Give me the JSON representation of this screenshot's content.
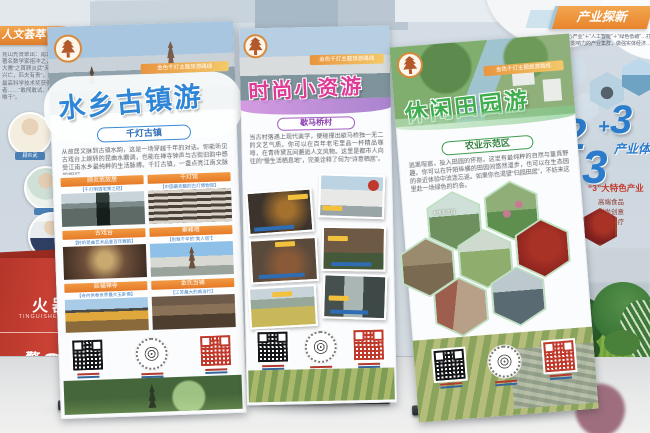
{
  "background": {
    "left_wall": {
      "ribbon_label": "人文荟萃",
      "info_text": "昆山先贤辈出：南北朝著名数学家祖冲之，“三大儒”之首顾炎武“天下兴亡，匹夫有责”，国家最高科学技术奖获得者……“敢闯敢试、唯实唯干”。",
      "figure_label": "顾炎武"
    },
    "fire_box": {
      "line1": "火器箱",
      "line2": "TINGUISHER·BOX",
      "line3": "警 ☎ 119",
      "line4": "ELEPHONE 119"
    },
    "right_wall": {
      "header": "产业探新",
      "intro": "以“核心产业”＋“人工智能”＋“绿色低碳”…打造具有影响力的产业集群，做强实体经济…",
      "num_left": "2",
      "plus": "+",
      "num_right": "3",
      "num_big": "3",
      "system_label": "产业体系",
      "feature_title": "“3”大特色产业",
      "feature_items": [
        "高端食品",
        "时尚创意",
        "休闲医疗"
      ]
    }
  },
  "banners": {
    "route_ribbon": "金色千灯主题旅游路线",
    "left": {
      "title": "水乡古镇游",
      "subtitle": "千灯古镇",
      "intro": "从故居文脉到古镇水韵，这是一场穿越千年的对话。你能听见古戏台上婉转的昆曲水磨调，也能在禅寺钟声与古街旧韵中感受江南水乡最纯粹的生活脉搏。千灯古镇，一盏点亮江南文脉的明灯。",
      "cards": [
        {
          "title": "顾炎武故居",
          "caption": "【千灯明清宅第之冠】"
        },
        {
          "title": "千灯馆",
          "caption": "【中国最完整的古灯博物馆】"
        },
        {
          "title": "古戏台",
          "caption": "【聆听昆曲艺术品鉴百年雅韵】"
        },
        {
          "title": "秦峰塔",
          "caption": "【别致千年的“美人塔”】"
        },
        {
          "title": "延福禅寺",
          "caption": "【寺内供奉世界最大玉卧佛】"
        },
        {
          "title": "金氏当铺",
          "caption": "【江苏最大的典当行】"
        }
      ]
    },
    "middle": {
      "title": "时尚小资游",
      "subtitle": "歇马桥村",
      "intro": "当古村落遇上现代美学，便碰撞出歇马桥独一无二的文艺气质。你可以在百年老宅里品一杯精品咖啡，在青砖黛瓦间邂逅人文风物。这里是都市人向往的“慢生活栖息地”，完美诠释了何为“诗意栖居”。"
    },
    "right": {
      "title": "休闲田园游",
      "subtitle": "农业示范区",
      "intro": "逃离喧嚣，投入田园的怀抱，这里有最纯粹的自然与童真野趣。你可以在阡陌纵横的田园间悠然漫步，也可以在生态园的亲近体验中流连忘返。如果你也渴望“归园田居”，不妨来这里赴一场绿色的约会。",
      "hex_label": "大唐生态园"
    }
  },
  "icons": {
    "logo": "qiandeng-pagoda-logo",
    "qr_styles": [
      "black-qr",
      "circle-logo-qr",
      "red-qr"
    ]
  },
  "colors": {
    "title_blue": "#2f85d6",
    "title_pink": "#e03a97",
    "title_green": "#3fae4e",
    "header_orange": "#ef8f3c",
    "firebox_red": "#c0392b"
  }
}
